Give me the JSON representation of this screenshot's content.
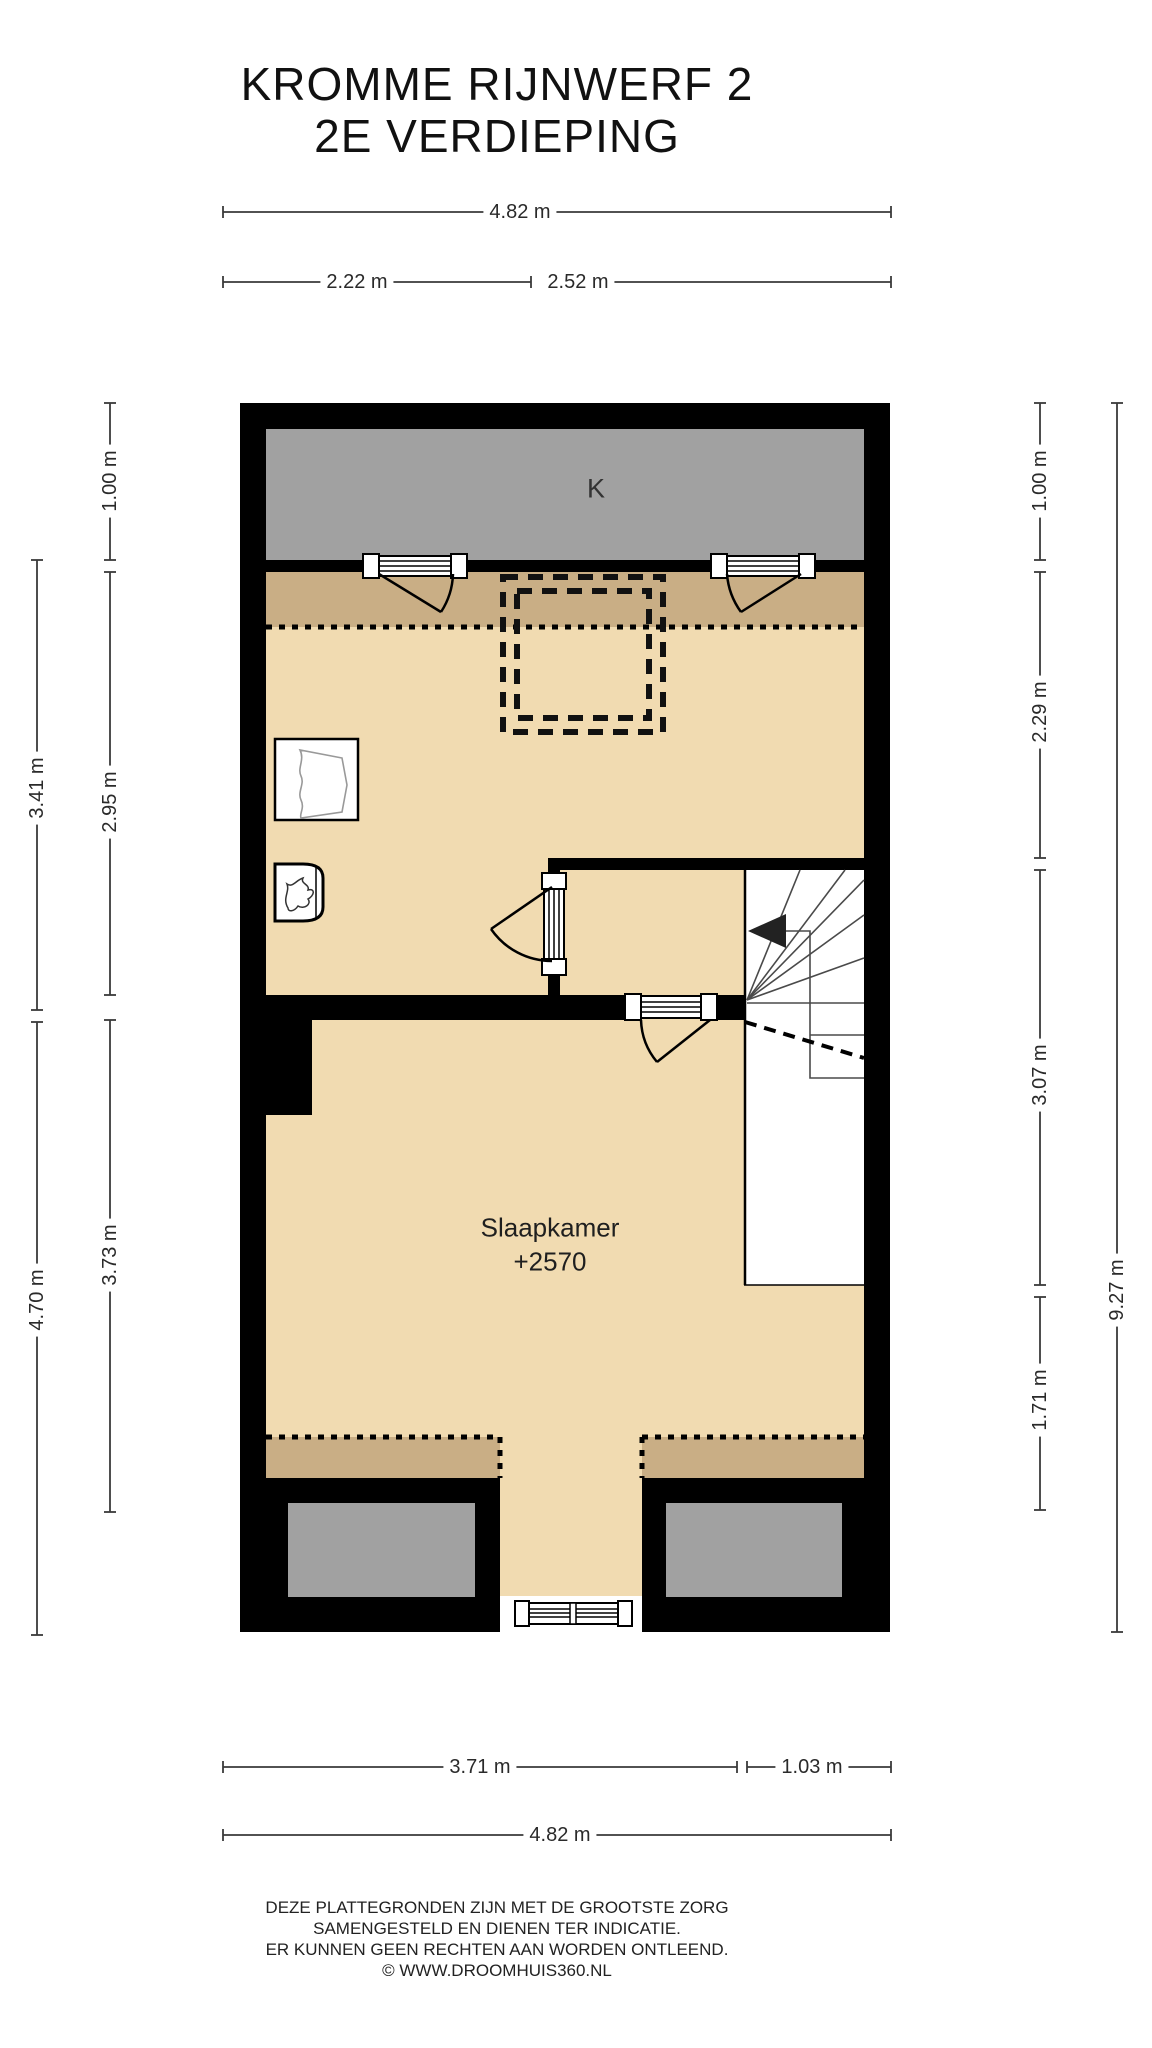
{
  "title": {
    "line1": "KROMME RIJNWERF 2",
    "line2": "2E VERDIEPING"
  },
  "rooms": {
    "closet_label": "K",
    "bedroom": {
      "name": "Slaapkamer",
      "level": "+2570"
    }
  },
  "dimensions": {
    "top": {
      "total": "4.82 m",
      "left_segment": "2.22 m",
      "right_segment": "2.52 m"
    },
    "bottom": {
      "left_segment": "3.71 m",
      "right_segment": "1.03 m",
      "total": "4.82 m"
    },
    "left": {
      "closet_depth": "1.00 m",
      "upper_room_outer": "3.41 m",
      "upper_room_inner": "2.95 m",
      "bedroom_outer": "4.70 m",
      "bedroom_inner": "3.73 m"
    },
    "right": {
      "closet_depth": "1.00 m",
      "upper_room": "2.29 m",
      "stairwell": "3.07 m",
      "bedroom": "1.71 m",
      "total": "9.27 m"
    }
  },
  "footer": {
    "line1": "DEZE PLATTEGRONDEN ZIJN MET DE GROOTSTE ZORG",
    "line2": "SAMENGESTELD EN DIENEN TER INDICATIE.",
    "line3": "ER KUNNEN GEEN RECHTEN AAN WORDEN ONTLEEND.",
    "line4": "© WWW.DROOMHUIS360.NL"
  },
  "colors": {
    "wall": "#000000",
    "closet_fill": "#a1a1a1",
    "low_headroom_fill": "#c9ae85",
    "floor_fill": "#f1dbb1",
    "dimension_line": "#3a3a3a"
  },
  "icons": {
    "boiler": "flame-icon",
    "stair_direction": "left-arrow-icon"
  }
}
